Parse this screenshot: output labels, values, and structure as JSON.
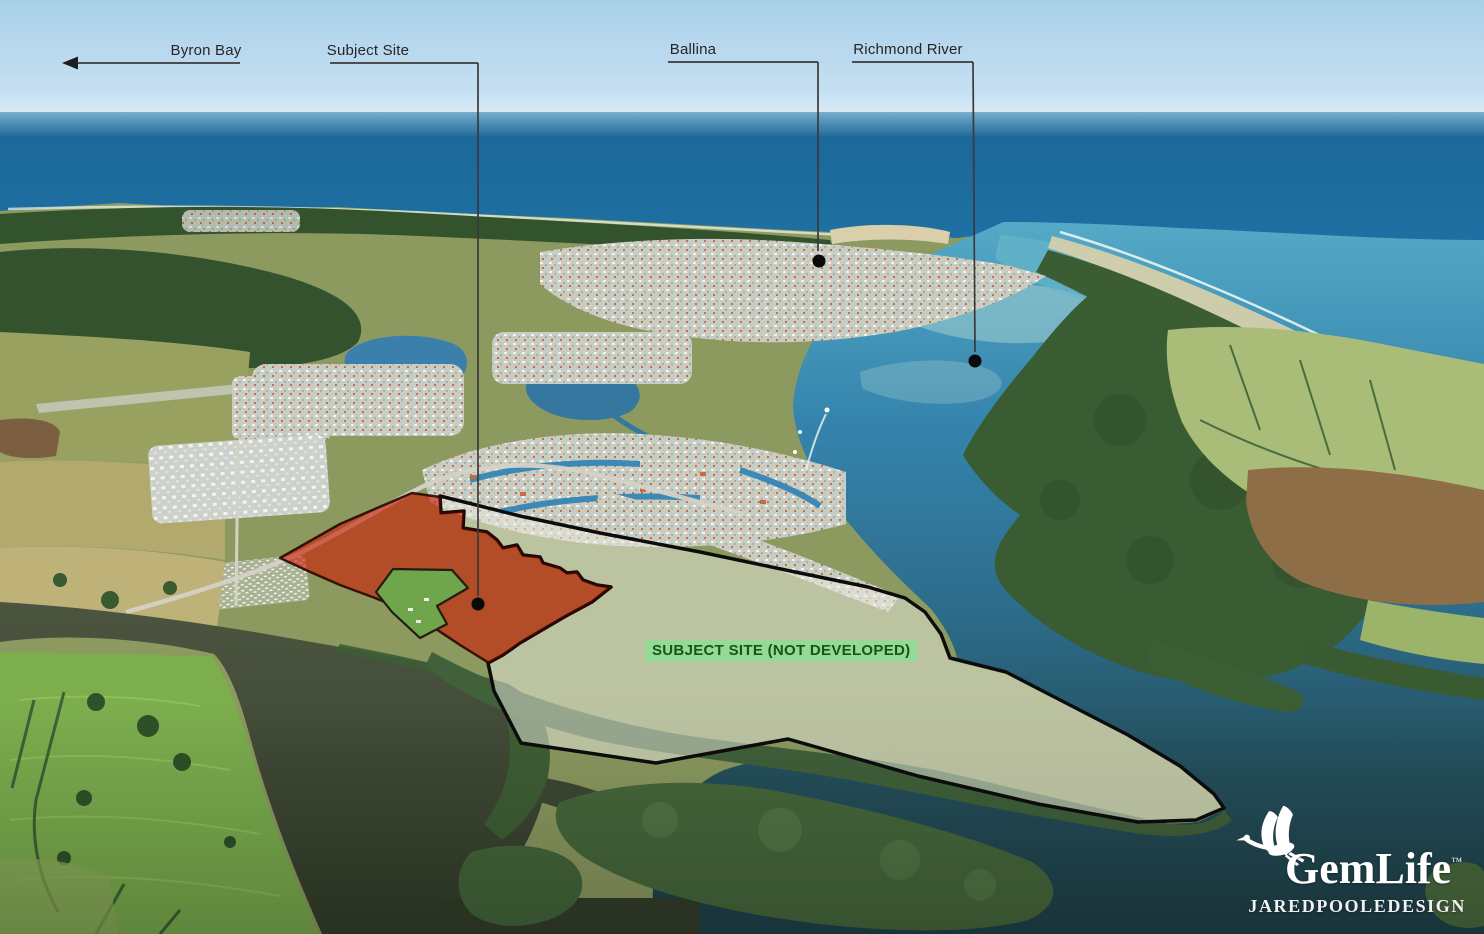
{
  "scene": {
    "type": "annotated-aerial-photograph",
    "subject": "coastal river town with development site overlay"
  },
  "labels": {
    "byron_bay": "Byron Bay",
    "subject_site": "Subject Site",
    "ballina": "Ballina",
    "richmond_river": "Richmond River"
  },
  "site_tag": {
    "text": "SUBJECT SITE (NOT DEVELOPED)",
    "bg_color": "#92db95",
    "text_color": "#14551a"
  },
  "overlays": {
    "developed_area_fill": "#cb1e06",
    "not_developed_area_fill": "#ebebe2",
    "boundary_color": "#0c0c0c",
    "leader_line_color": "#3a3a3a",
    "marker_dot_color": "#0a0a0a"
  },
  "logo": {
    "brand": "GemLife",
    "trademark": "™",
    "studio": "JAREDPOOLEDESIGN",
    "color": "#ffffff",
    "icon": "egret-bird-icon"
  }
}
